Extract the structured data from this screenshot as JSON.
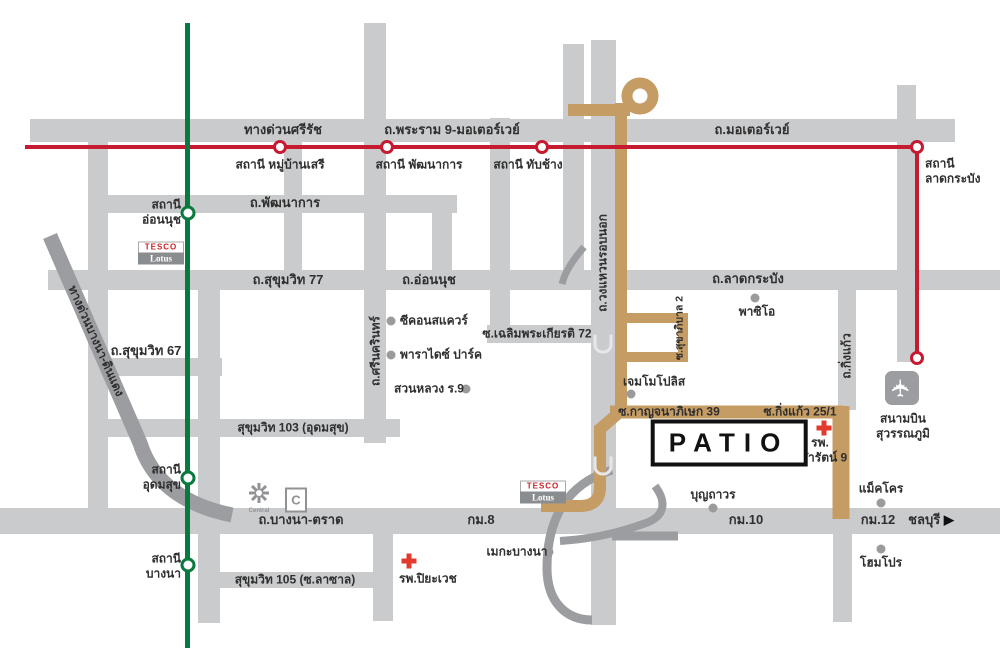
{
  "title": "PATIO location map",
  "colors": {
    "road": "#c9cbcd",
    "ramp": "#9b9da0",
    "route_tan": "#c59c63",
    "rail_red": "#c51a30",
    "rail_green": "#077a3d",
    "cross_red": "#e23b2e",
    "text": "#2f2f2f",
    "poi_dot": "#9b9b9b",
    "logo_gray": "#8a8d90",
    "tesco_red": "#cc2128"
  },
  "icons": {
    "airplane": "✈",
    "arrow_right": "▶"
  },
  "roads": {
    "expressway_sirat": "ทางด่วนศรีรัช",
    "rama9_motorway": "ถ.พระราม 9-มอเตอร์เวย์",
    "motorway": "ถ.มอเตอร์เวย์",
    "pattanakan": "ถ.พัฒนาการ",
    "sukhumvit77": "ถ.สุขุมวิท 77",
    "onnut": "ถ.อ่อนนุช",
    "ladkrabang": "ถ.ลาดกระบัง",
    "chalermprakiat72": "ซ.เฉลิมพระเกียรติ 72",
    "sukhumvit67": "ถ.สุขุมวิท 67",
    "srinakarin": "ถ.ศรีนครินทร์",
    "sukhumvit103": "สุขุมวิท 103 (อุดมสุข)",
    "outer_ring": "ถ.วงแหวนรอบนอก",
    "sukhaphiban2": "ซ.สุขาภิบาล 2",
    "kingkaeo": "ถ.กิ่งแก้ว",
    "kanchanaphisek39": "ซ.กาญจนาภิเษก 39",
    "kingkaeo25_1": "ซ.กิ่งแก้ว 25/1",
    "bangna_trat": "ถ.บางนา-ตราด",
    "sukhumvit105": "สุขุมวิท 105 (ซ.ลาซาล)",
    "expressway_bangna": "ทางด่วนบางนา-ดินแดง",
    "km8": "กม.8",
    "km10": "กม.10",
    "km12": "กม.12",
    "chonburi": "ชลบุรี"
  },
  "stations": {
    "mubanseri": "สถานี หมู่บ้านเสรี",
    "phatthanakan": "สถานี พัฒนาการ",
    "thapchang": "สถานี ทับช้าง",
    "latkrabang": "สถานี\nลาดกระบัง",
    "onnut": "สถานี\nอ่อนนุช",
    "udomsuk": "สถานี\nอุดมสุข",
    "bangna": "สถานี\nบางนา"
  },
  "places": {
    "seacon": "ซีคอนสแควร์",
    "paradise": "พาราไดซ์ ปาร์ค",
    "suanluang": "สวนหลวง ร.9",
    "paseo": "พาซิโอ",
    "gemopolis": "เจมโมโปลิส",
    "boonthavorn": "บุญถาวร",
    "megabangna": "เมกะบางนา",
    "makro": "แม็คโคร",
    "homepro": "โฮมโปร",
    "piyavech_hospital": "รพ.ปิยะเวช",
    "chularat9_hospital": "รพ.\nจุฬารัตน์ 9",
    "suvarnabhumi": "สนามบิน\nสุวรรณภูมิ"
  },
  "logos": {
    "tesco": "TESCO",
    "lotus": "Lotus",
    "central": "Central",
    "central_c": "C"
  },
  "project": {
    "name": "PATIO"
  }
}
